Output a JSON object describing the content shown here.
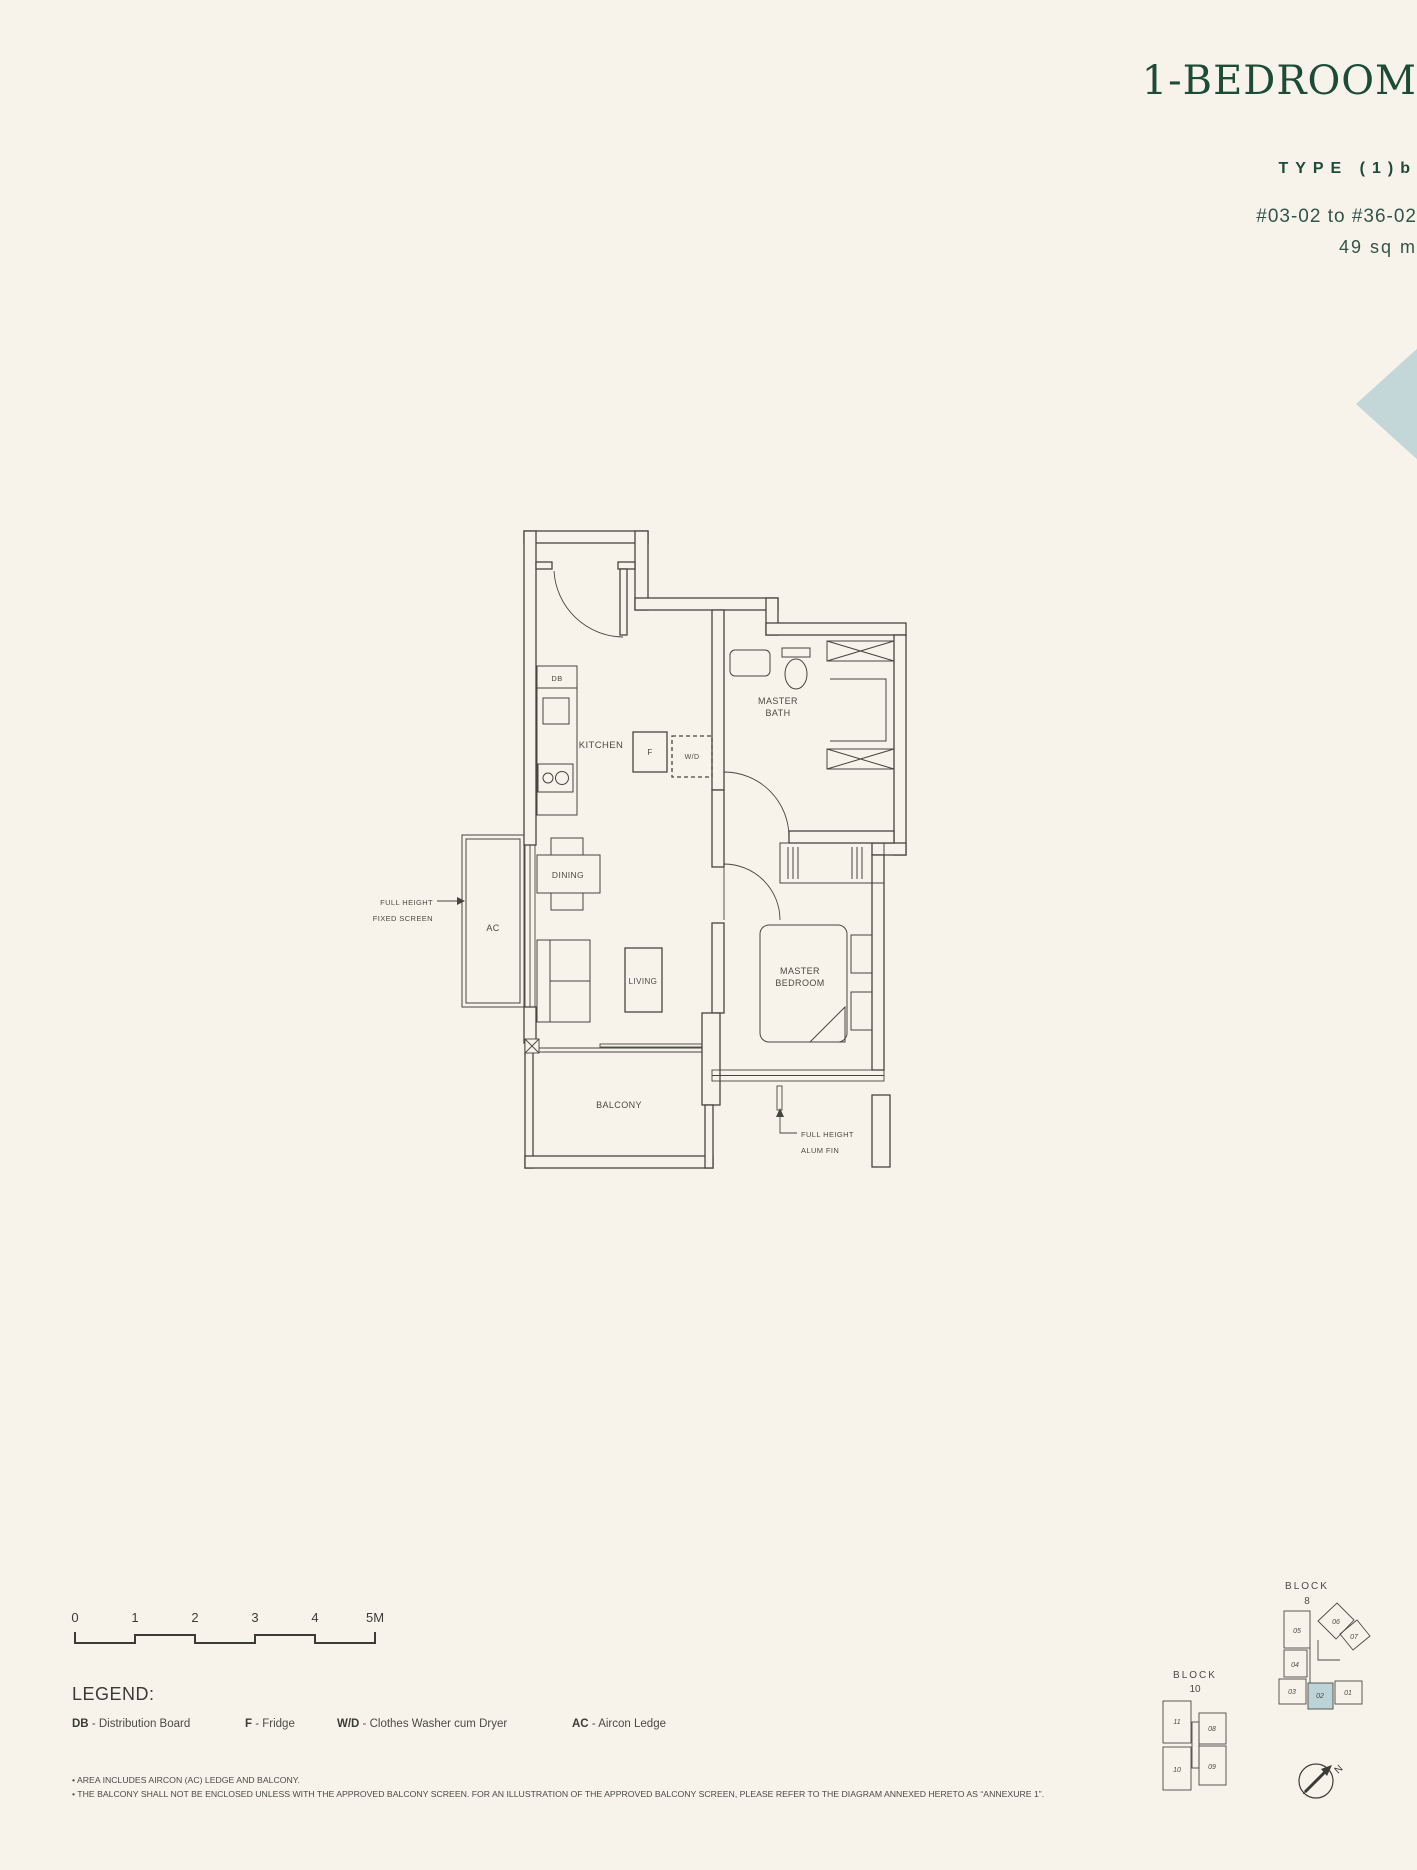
{
  "header": {
    "title": "1-BEDROOM",
    "type_label": "TYPE (1)b",
    "units": "#03-02 to #36-02",
    "area": "49 sq m"
  },
  "colors": {
    "background": "#f7f3ea",
    "accent_green": "#1d4b35",
    "plan_line": "#46463f",
    "highlight_teal": "#c4d7d8",
    "unit_highlight": "#bcd4d8"
  },
  "floor_plan": {
    "rooms": {
      "kitchen": "KITCHEN",
      "dining": "DINING",
      "living": "LIVING",
      "balcony": "BALCONY",
      "master_bath_line1": "MASTER",
      "master_bath_line2": "BATH",
      "master_bedroom_line1": "MASTER",
      "master_bedroom_line2": "BEDROOM",
      "ac": "AC",
      "db": "DB",
      "fridge": "F",
      "washer_dryer": "W/D"
    },
    "annotations": {
      "fixed_screen_line1": "FULL HEIGHT",
      "fixed_screen_line2": "FIXED SCREEN",
      "alum_fin_line1": "FULL HEIGHT",
      "alum_fin_line2": "ALUM FIN"
    }
  },
  "scale_bar": {
    "labels": [
      "0",
      "1",
      "2",
      "3",
      "4",
      "5M"
    ]
  },
  "legend": {
    "heading": "LEGEND:",
    "items": [
      {
        "abbr": "DB",
        "desc": " - Distribution Board"
      },
      {
        "abbr": "F",
        "desc": " - Fridge"
      },
      {
        "abbr": "W/D",
        "desc": " - Clothes Washer cum Dryer"
      },
      {
        "abbr": "AC",
        "desc": " - Aircon Ledge"
      }
    ]
  },
  "key_plan": {
    "block8": {
      "label_line1": "BLOCK",
      "label_line2": "8",
      "units": [
        "05",
        "06",
        "07",
        "04",
        "03",
        "02",
        "01"
      ],
      "highlighted_unit": "02"
    },
    "block10": {
      "label_line1": "BLOCK",
      "label_line2": "10",
      "units": [
        "11",
        "08",
        "09",
        "10"
      ]
    },
    "north_label": "N"
  },
  "footnotes": [
    "• AREA INCLUDES AIRCON (AC) LEDGE AND BALCONY.",
    "• THE BALCONY SHALL NOT BE ENCLOSED UNLESS WITH THE APPROVED BALCONY SCREEN. FOR AN ILLUSTRATION OF THE APPROVED BALCONY SCREEN, PLEASE REFER TO THE DIAGRAM ANNEXED HERETO AS “ANNEXURE 1”."
  ]
}
